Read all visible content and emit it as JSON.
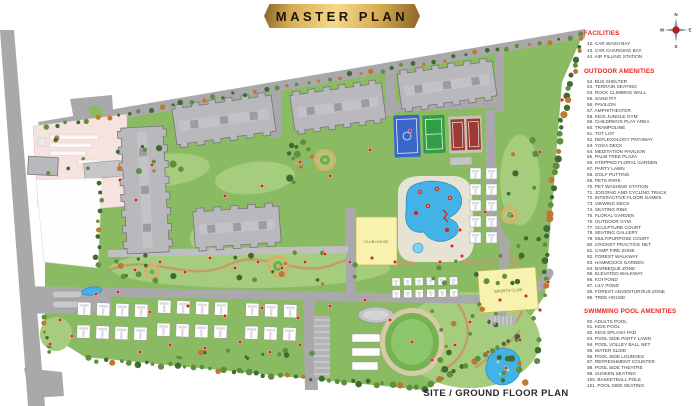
{
  "title": "MASTER PLAN",
  "caption": "SITE / GROUND FLOOR PLAN",
  "compass": {
    "n": "N",
    "e": "E",
    "s": "S",
    "w": "W"
  },
  "map_labels": {
    "club_house": "CLUB HOUSE",
    "sports_club": "SPORTS CLUB"
  },
  "legend": {
    "sections": [
      {
        "heading": "FACILITIES",
        "items": [
          "42. CAR WASH BAY",
          "43. CAR CHARGING BAY",
          "44. AIR FILLING STATION"
        ]
      },
      {
        "heading": "OUTDOOR AMENITIES",
        "items": [
          "52. BUS SHELTER",
          "53. TERRAIN SEATING",
          "54. ROCK CLIMBING WALL",
          "55. SAND PIT",
          "56. PAVILION",
          "57. AMPHITHEATER",
          "58. KIDS JUNGLE GYM",
          "59. CHILDREN'S PLAY AREA",
          "60. TRAMPOLINE",
          "61. TOT LOT",
          "62. REFLEXOLOGY PATHWAY",
          "63. YOGA DECK",
          "64. MEDITATION PAVILION",
          "65. PALM TREE PLAZA",
          "66. STEPPED FLORAL GARDEN",
          "67. PARTY LAWN",
          "68. GOLF PUTTING",
          "69. PETS PARK",
          "70. PET WASHING STATION",
          "71. JOGGING AND CYCLING TRACK",
          "72. INTERACTIVE FLOOR GAMES",
          "73. VIEWING DECK",
          "74. SKATING RINK",
          "75. FLORAL GARDEN",
          "76. OUTDOOR GYM",
          "77. SCULPTURE COURT",
          "78. SEATING GALLERY",
          "79. MULTIPURPOSE COURT",
          "80. CRICKET PRACTICE NET",
          "81. CAMP FIRE ZONE",
          "82. FOREST WALKWAY",
          "83. HAMMOCKS GARDEN",
          "84. BARBEQUE ZONE",
          "85. ELEVATED WALKWAY",
          "86. KOI POND",
          "87. LILY POND",
          "88. FOREST ADVENTUROUS ZONE",
          "89. TREE HOUSE"
        ]
      },
      {
        "heading": "SWIMMING POOL AMENITIES",
        "items": [
          "90. ADULTS POOL",
          "91. KIDS POOL",
          "92. KIDS SPLASH PAD",
          "93. POOL SIDE PARTY LAWN",
          "94. POOL VOLLEY BALL NET",
          "95. WATER SLIDE",
          "96. POOL SIDE LOUNGES",
          "97. REFRESHMENT COUNTER",
          "98. POOL SIDE THEATRE",
          "99. SUNKEN SEATING",
          "100. BASKETBALL POLE",
          "101. POOL SIDE SEATING"
        ]
      }
    ]
  },
  "colors": {
    "banner-gold": "#d9ac55",
    "banner-gold-light": "#f3d98b",
    "banner-gold-dark": "#8a6426",
    "banner-text": "#1c150a",
    "legend-heading": "#e8251f",
    "legend-item": "#3c3c3c",
    "caption-text": "#2b2b2b",
    "lawn": "#8abb63",
    "lawn-light": "#a6cd7d",
    "road": "#a9a9ab",
    "building": "#b9b9bd",
    "villa": "#ffffff",
    "water": "#43b2e6",
    "club-yellow": "#f7f2ae",
    "court-blue": "#3a66c8",
    "court-green": "#2f9e44",
    "court-red": "#9e3a34",
    "tree-dark": "#3e6b30",
    "tree-mid": "#5f8f3e",
    "tree-autumn": "#c07830",
    "marker-red": "#d92121",
    "parcel-pink": "#f6e3e0"
  }
}
